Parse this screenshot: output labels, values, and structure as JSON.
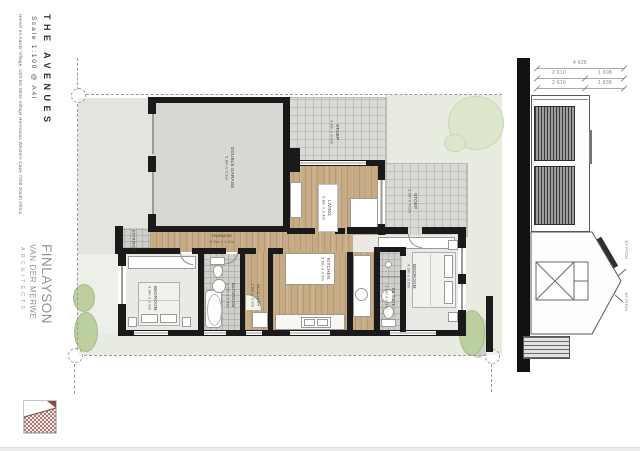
{
  "sidebar": {
    "title": "THE AVENUES",
    "scale": "Scale 1:100 @ A4l",
    "address": "Hemel en Aarde Village, Unit 5G Wine Village Hermanus Western Cape 7200 South Africa"
  },
  "logo": {
    "line1": "FINLAYSON",
    "line2": "VAN DER MERWE",
    "line3": "ARCHITECTS"
  },
  "plan": {
    "rooms": [
      {
        "name": "DOUBLE GARAGE",
        "dims": "5.8m x 5.9m"
      },
      {
        "name": "STOEP",
        "dims": "4.6m x 4.0m"
      },
      {
        "name": "STOEP",
        "dims": "3.0m x 4.0m"
      },
      {
        "name": "LIVING",
        "dims": "3.8m x 3.4m"
      },
      {
        "name": "KITCHEN",
        "dims": "3.9m x 4.9m"
      },
      {
        "name": "PASSAGE",
        "dims": "6.9m x 1.0m"
      },
      {
        "name": "ENTRANCE",
        "dims": ""
      },
      {
        "name": "BEDROOM",
        "dims": "3.9m x 2.9m"
      },
      {
        "name": "BATHROOM",
        "dims": "1.7m x 3.4m"
      },
      {
        "name": "SCULLERY",
        "dims": "1.5m x 3.0m"
      },
      {
        "name": "BEDROOM",
        "dims": "4.3m x 3.6m"
      },
      {
        "name": "EN-SUITE",
        "dims": "1.4m x 3.1m"
      }
    ]
  },
  "elevation": {
    "dims": {
      "total": "4 628",
      "upper_left": "2 610",
      "upper_right": "1 608",
      "lower_left": "2 610",
      "lower_right": "1 838"
    },
    "pitch_upper": "30° PITCH",
    "pitch_lower": "30° PITCH"
  },
  "colors": {
    "wall": "#1a1a1a",
    "wood": "#c7ab85",
    "lawn": "#e8ece0",
    "tile": "#d9d9d5",
    "logo_accent": "#8a4c44"
  }
}
